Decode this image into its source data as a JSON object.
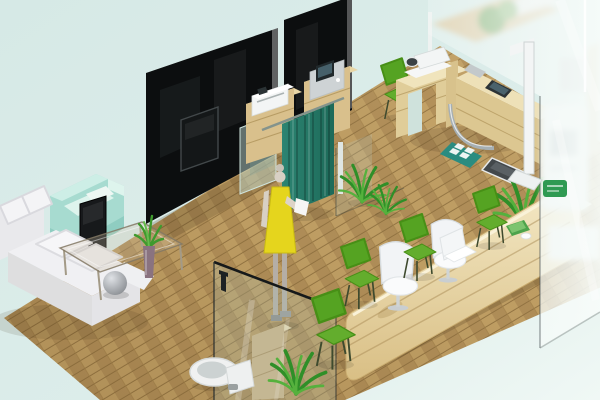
{
  "scene": {
    "type": "isometric-interior-3d-render",
    "setting": "clinic-office interior cutaway",
    "view": "isometric from upper-left"
  },
  "palette": {
    "bg_top": "#d6e9e6",
    "bg_bottom": "#f0f8f5",
    "floor_wood": "#c2a166",
    "floor_wood_alt": "#b2905a",
    "floor_seam": "#8f7140",
    "wall_black": "#0c0e0f",
    "glass_tint": "rgba(173,195,183,0.25)",
    "glass_edge": "#16191a",
    "curtain": "#2c8472",
    "curtain_dark": "#1d6a59",
    "sofa": "#e9e9ec",
    "sofa_light": "#f4f4f6",
    "sofa_mid": "#dededf",
    "armchair": "#a7dbd0",
    "armchair_light": "#def4ed",
    "armchair_dark": "#8fcdc1",
    "green_chair": "#55a322",
    "green_chair_seat": "#63ad2d",
    "white_chair": "#f2f4f6",
    "desk_wood": "#e0cd99",
    "desk_wood_light": "#f0e4bc",
    "desk_wood_dark": "#cdb37c",
    "counter_wood": "#e9d6a4",
    "counter_wood_light": "#f4e9c6",
    "cabinet_wood": "#d9c08c",
    "device_white": "#f3f5f5",
    "device_gray": "#ced3d5",
    "screen_dark": "#20282b",
    "tv_dark": "#141718",
    "plant": "#2f8f28",
    "plant_light": "#55b13d",
    "figure_dress": "#e5d51d",
    "figure_skin": "#d8d0c4",
    "figure_leg": "#b5aea6",
    "toilet_white": "#f0f1f1",
    "mat_teal": "#2a8c80",
    "sign_green": "#2f9a52",
    "chrome": "#a6afb3",
    "frost": "#f5faf8",
    "shadow": "rgba(70,50,25,0.22)"
  },
  "objects": [
    {
      "id": "wood-floor",
      "label": "light oak plank floor, isometric diamond"
    },
    {
      "id": "black-wall-panel-left",
      "label": "glossy black partition wall with mounted TV"
    },
    {
      "id": "black-wall-panel-center",
      "label": "glossy black partition wall, cut by top edge"
    },
    {
      "id": "wall-tv",
      "label": "flat screen mounted on black wall"
    },
    {
      "id": "printer-cabinet",
      "label": "wood cabinet with white printer"
    },
    {
      "id": "scanner-cabinet",
      "label": "wood cabinet with gray device and screen"
    },
    {
      "id": "privacy-curtain",
      "label": "teal privacy curtain on rail"
    },
    {
      "id": "standing-woman",
      "label": "mannequin woman in yellow dress holding paper"
    },
    {
      "id": "floor-plants",
      "label": "two green floor palms in corridor"
    },
    {
      "id": "exam-desk",
      "label": "pine exam desk with devices and chrome tube"
    },
    {
      "id": "exam-device",
      "label": "white optical device on exam desk"
    },
    {
      "id": "exam-chair",
      "label": "green chair at exam desk"
    },
    {
      "id": "foot-mat",
      "label": "teal mat with four white pads"
    },
    {
      "id": "weight-platform",
      "label": "dark gray platform scale"
    },
    {
      "id": "height-rod",
      "label": "white vertical measuring rod"
    },
    {
      "id": "waiting-sofa",
      "label": "white L-shaped sectional sofa"
    },
    {
      "id": "sphere-lamp",
      "label": "gray sphere on sofa corner"
    },
    {
      "id": "mint-armchair",
      "label": "mint green cube armchair"
    },
    {
      "id": "floor-tv-stand",
      "label": "black TV on floor stand facing sofa"
    },
    {
      "id": "coffee-table",
      "label": "glass coffee table on thin legs"
    },
    {
      "id": "aloe-vase",
      "label": "mauve vase with aloe plant on table"
    },
    {
      "id": "bathroom-glass-door",
      "label": "glass partition with dark handle"
    },
    {
      "id": "toilet",
      "label": "white toilet"
    },
    {
      "id": "bathroom-cabinet",
      "label": "wood shelf cabinet behind glass"
    },
    {
      "id": "bathroom-plant",
      "label": "leafy plant at bathroom corner"
    },
    {
      "id": "reception-counter",
      "label": "long rounded blond-wood reception counter"
    },
    {
      "id": "staff-chairs",
      "label": "two white shell chairs at counter"
    },
    {
      "id": "reception-laptop",
      "label": "white laptop on counter"
    },
    {
      "id": "visitor-chairs",
      "label": "row of green visitor chairs"
    },
    {
      "id": "reception-plant",
      "label": "palm behind counter right end"
    },
    {
      "id": "frosted-glass-wall",
      "label": "tall frosted glass wall on right"
    },
    {
      "id": "self-service-kiosk",
      "label": "blurred white kiosk behind frosted glass"
    },
    {
      "id": "wall-sign",
      "label": "small green sign on glass"
    }
  ]
}
